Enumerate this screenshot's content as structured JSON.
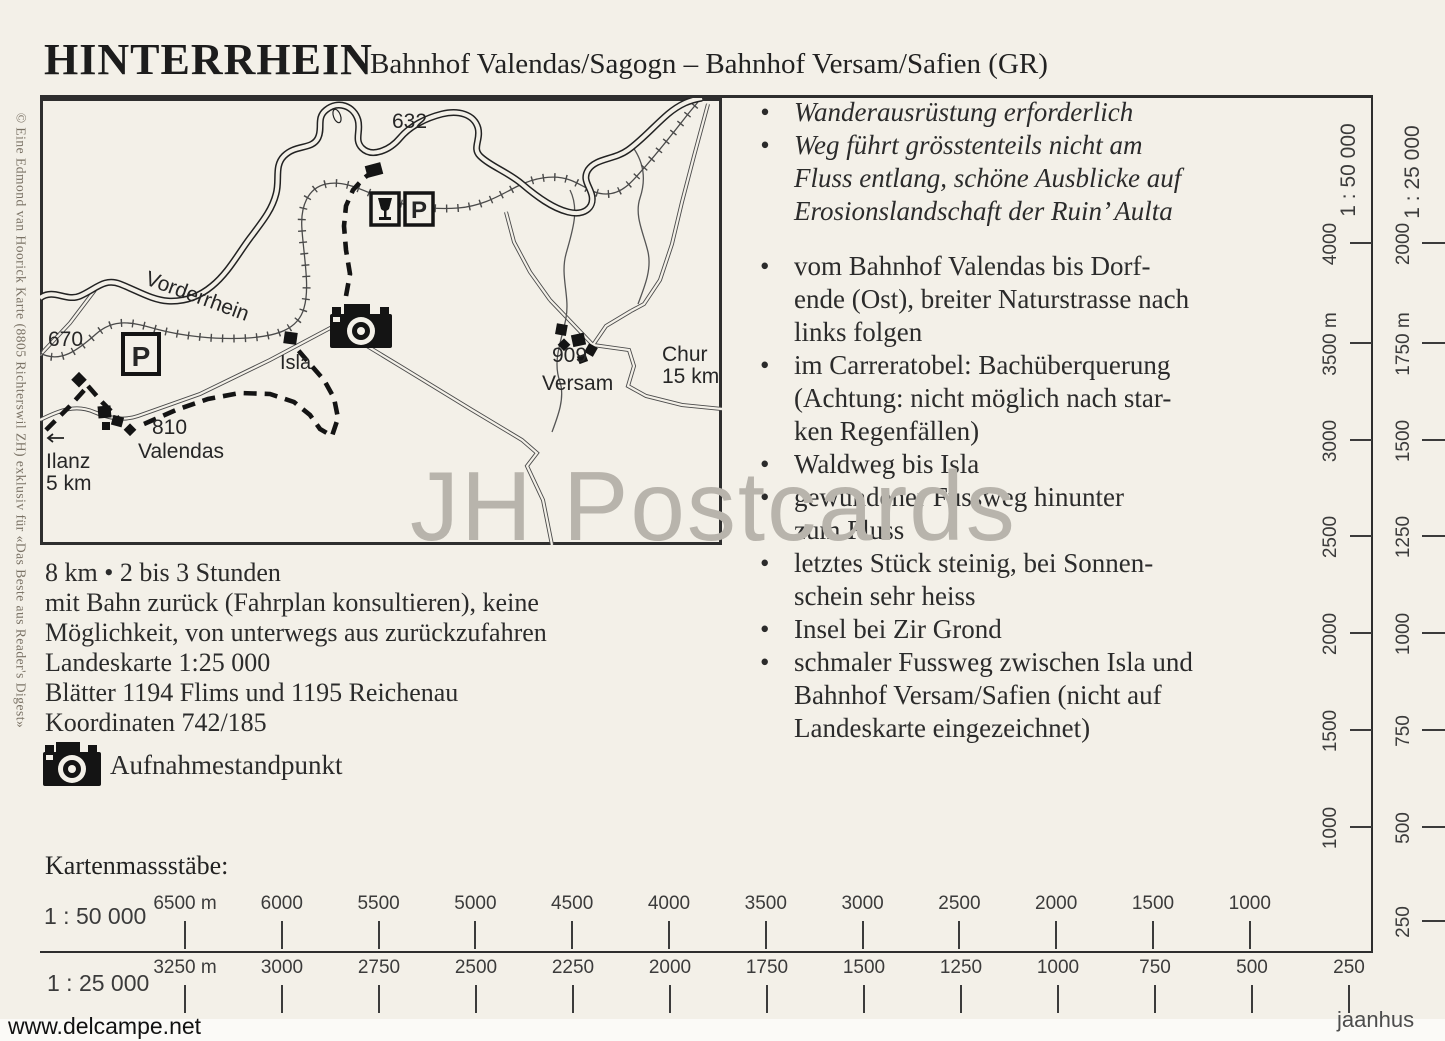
{
  "header": {
    "title": "HINTERRHEIN",
    "subtitle": "Bahnhof Valendas/Sagogn – Bahnhof Versam/Safien (GR)"
  },
  "map": {
    "labels": {
      "elev_top": "632",
      "elev_left": "670",
      "river": "Vorderrhein",
      "isla": "Isla",
      "valendas_elev": "810",
      "valendas": "Valendas",
      "ilanz": "Ilanz",
      "ilanz_dist": "5 km",
      "versam_elev": "909",
      "versam": "Versam",
      "chur": "Chur",
      "chur_dist": "15 km",
      "parking": "P"
    }
  },
  "info": {
    "lines": [
      "8 km • 2 bis 3 Stunden",
      "mit Bahn zurück (Fahrplan konsultieren), keine",
      "Möglichkeit, von unterwegs aus zurückzufahren",
      "Landeskarte 1:25 000",
      "Blätter 1194 Flims und 1195 Reichenau",
      "Koordinaten 742/185"
    ],
    "camera_legend": "Aufnahmestandpunkt"
  },
  "notes": {
    "bullet_char": "•",
    "bullets": [
      {
        "text": "Wanderausrüstung erforderlich",
        "italic": true
      },
      {
        "text": "Weg führt grösstenteils nicht am\nFluss entlang, schöne Ausblicke auf\nErosionslandschaft der Ruin’ Aulta",
        "italic": true
      },
      {
        "text": "vom Bahnhof Valendas bis Dorf-\nende (Ost), breiter Naturstrasse nach\nlinks folgen",
        "gap_before": true
      },
      {
        "text": "im Carreratobel: Bachüberquerung\n(Achtung: nicht möglich nach star-\nken Regenfällen)"
      },
      {
        "text": "Waldweg bis Isla"
      },
      {
        "text": "gewundener Fussweg hinunter\nzum Fluss"
      },
      {
        "text": "letztes Stück steinig, bei Sonnen-\nschein sehr heiss"
      },
      {
        "text": "Insel bei Zir Grond"
      },
      {
        "text": "schmaler Fussweg zwischen Isla und\nBahnhof Versam/Safien (nicht auf\nLandeskarte eingezeichnet)"
      }
    ]
  },
  "scales": {
    "heading": "Kartenmassstäbe:",
    "horizontal": [
      {
        "label": "1 : 50 000",
        "ticks": [
          "6500 m",
          "6000",
          "5500",
          "5000",
          "4500",
          "4000",
          "3500",
          "3000",
          "2500",
          "2000",
          "1500",
          "1000"
        ]
      },
      {
        "label": "1 : 25 000",
        "ticks": [
          "3250 m",
          "3000",
          "2750",
          "2500",
          "2250",
          "2000",
          "1750",
          "1500",
          "1250",
          "1000",
          "750",
          "500",
          "250"
        ]
      }
    ],
    "vertical": [
      {
        "label": "1 : 50 000",
        "ticks": [
          "4000",
          "3500 m",
          "3000",
          "2500",
          "2000",
          "1500",
          "1000"
        ]
      },
      {
        "label": "1 : 25 000",
        "ticks": [
          "2000",
          "1750 m",
          "1500",
          "1250",
          "1000",
          "750",
          "500",
          "250"
        ]
      }
    ]
  },
  "credits": {
    "copyright": "© Eine Edmond van Hoorick Karte (8805 Richterswil ZH) exklusiv für «Das Beste aus Reader's Digest»",
    "watermark_center": "JH Postcards",
    "watermark_bottom_left": "www.delcampe.net",
    "watermark_bottom_right": "jaanhus"
  }
}
